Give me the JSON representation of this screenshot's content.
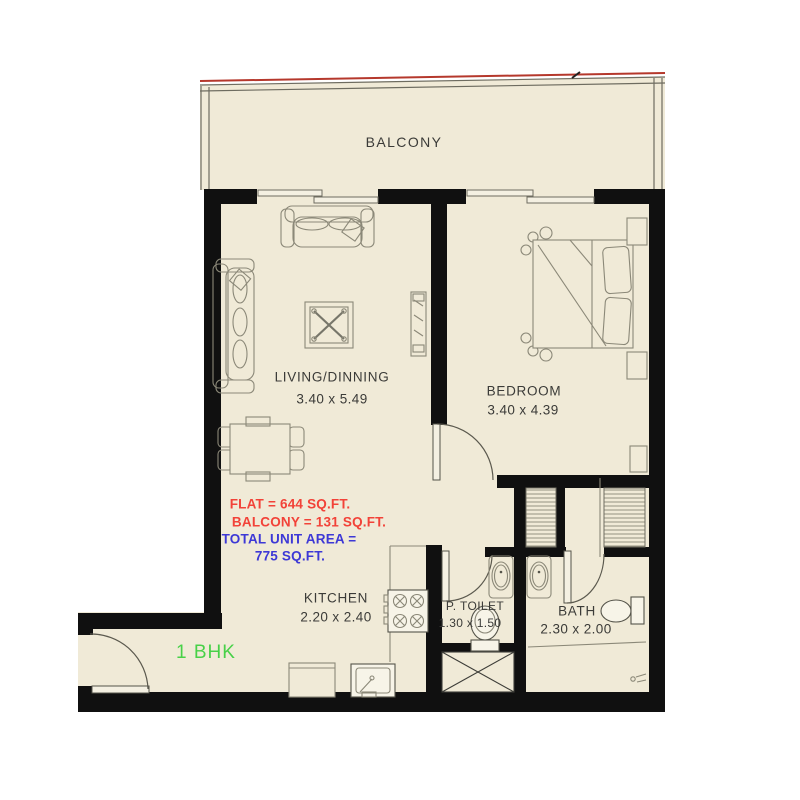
{
  "unit": {
    "type_label": "1 BHK"
  },
  "rooms": {
    "balcony": {
      "name": "BALCONY"
    },
    "living": {
      "name": "LIVING/DINNING",
      "dims": "3.40 x 5.49"
    },
    "bedroom": {
      "name": "BEDROOM",
      "dims": "3.40 x 4.39"
    },
    "kitchen": {
      "name": "KITCHEN",
      "dims": "2.20 x 2.40"
    },
    "powder_toilet": {
      "name": "P. TOILET",
      "dims": "1.30 x 1.50"
    },
    "bath": {
      "name": "BATH",
      "dims": "2.30 x 2.00"
    }
  },
  "area_summary": {
    "flat": "FLAT = 644 SQ.FT.",
    "balcony": "BALCONY = 131 SQ.FT.",
    "total_label": "TOTAL UNIT AREA =",
    "total_value": "775 SQ.FT."
  },
  "colors": {
    "wall": "#101010",
    "floor": "#f0ead7",
    "line": "#8b8878",
    "label": "#3b3b38",
    "accent-red": "#f24238",
    "accent-blue": "#3d38d6",
    "accent-green": "#48d148",
    "railing-red": "#b5382c"
  }
}
